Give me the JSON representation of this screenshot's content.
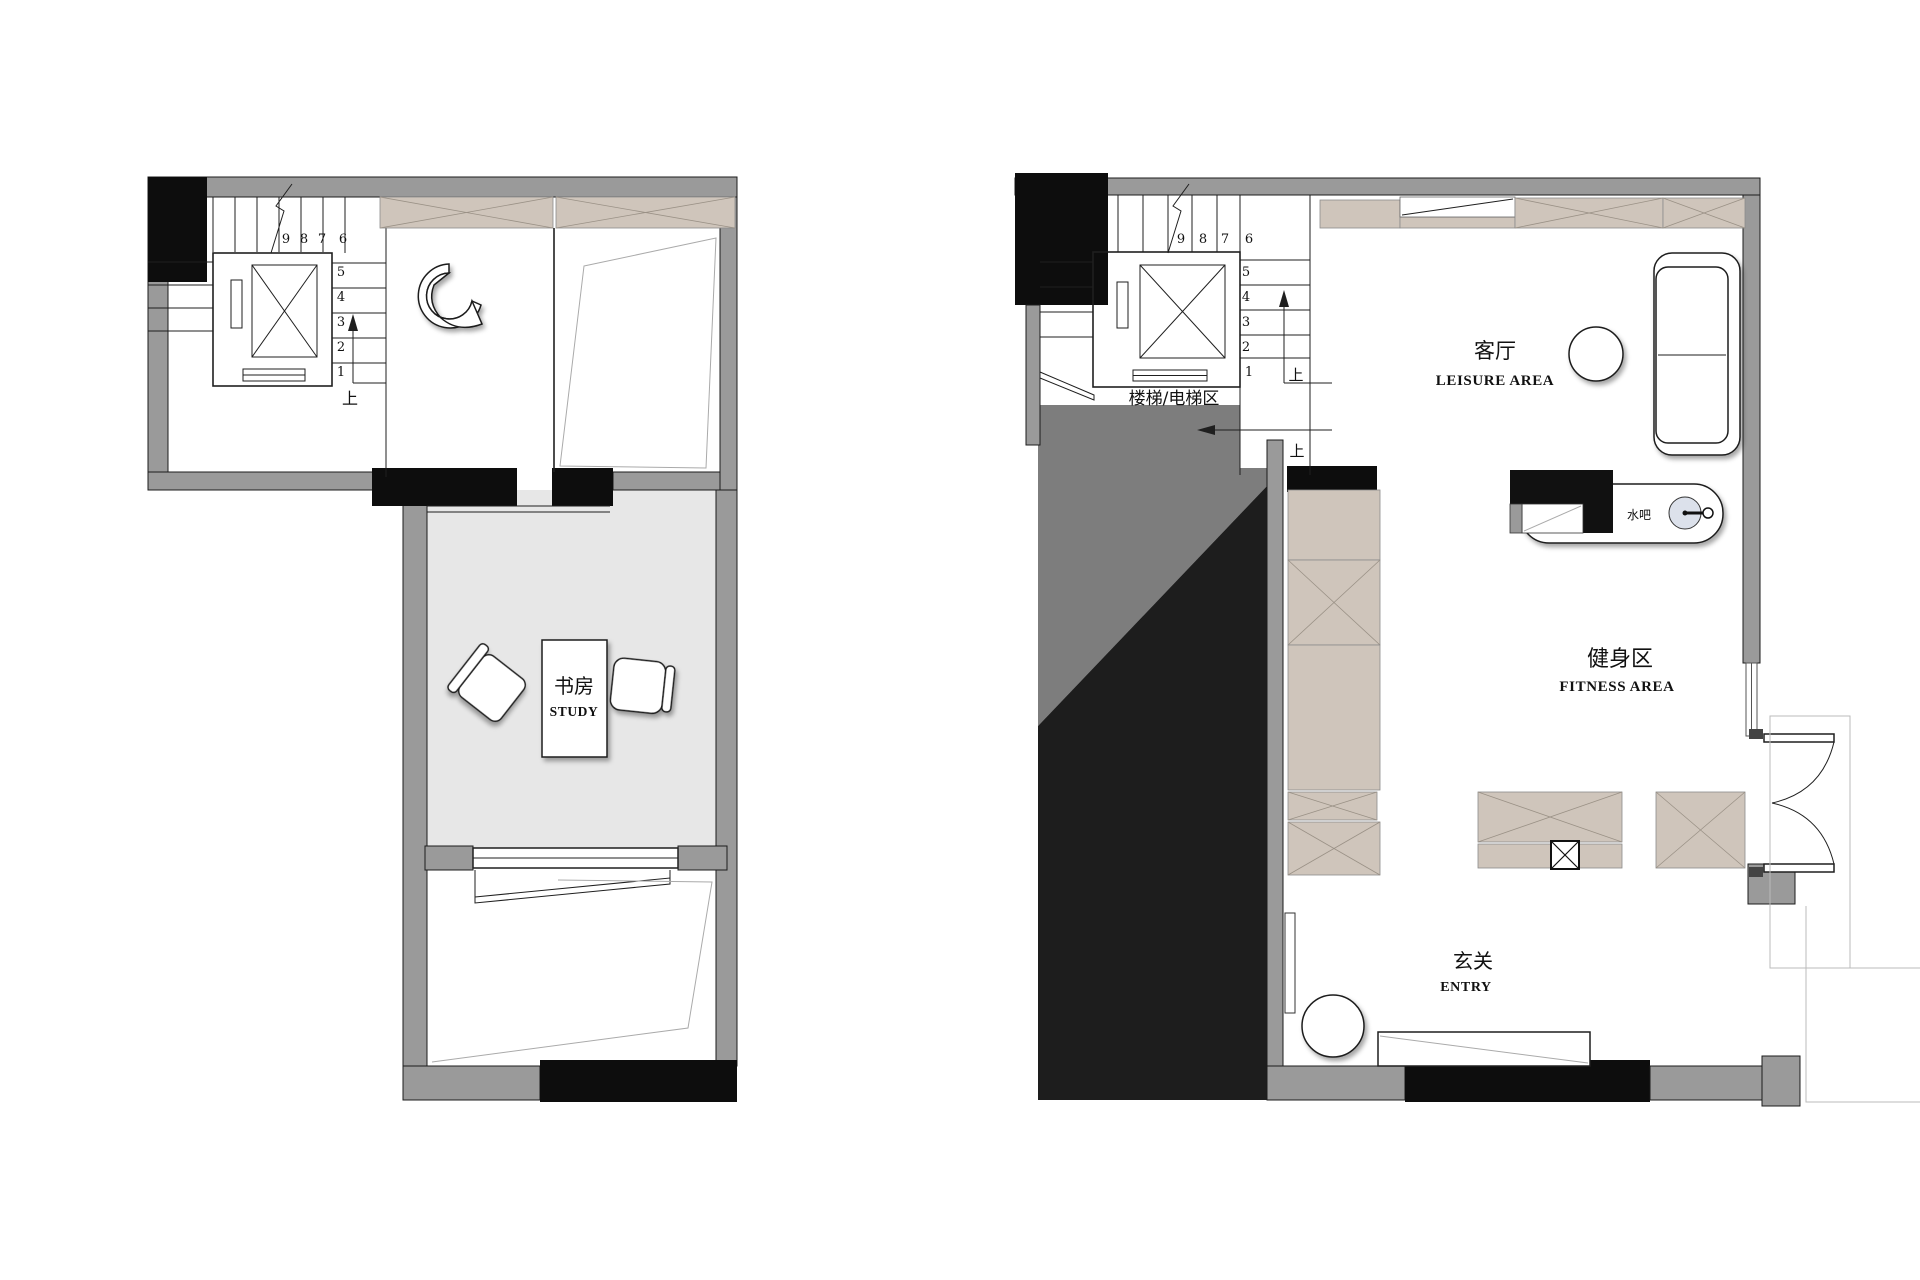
{
  "title_hidden": "",
  "colors": {
    "wall_gray": "#9A9A9A",
    "wall_black": "#0D0D0D",
    "void_black": "#1D1D1D",
    "void_gray": "#7D7D7D",
    "cabinet_tan": "#CFC5BB",
    "study_floor": "#E7E7E7",
    "sink_fill": "#DCE1EB",
    "line_dark": "#1F1F1F",
    "line_faint": "#BBBBBB"
  },
  "left_plan": {
    "study": {
      "zh": "书房",
      "en": "STUDY"
    },
    "stairs": {
      "top_numbers": [
        "9",
        "8",
        "7",
        "6"
      ],
      "side_numbers": [
        "5",
        "4",
        "3",
        "2",
        "1"
      ],
      "up_label": "上"
    }
  },
  "right_plan": {
    "stair_area_label": "楼梯/电梯区",
    "stairs": {
      "top_numbers": [
        "9",
        "8",
        "7",
        "6"
      ],
      "side_numbers": [
        "5",
        "4",
        "3",
        "2",
        "1"
      ],
      "up_label_1": "上",
      "up_label_2": "上"
    },
    "leisure": {
      "zh": "客厅",
      "en": "LEISURE AREA"
    },
    "fitness": {
      "zh": "健身区",
      "en": "FITNESS AREA"
    },
    "entry": {
      "zh": "玄关",
      "en": "ENTRY"
    },
    "water_bar": "水吧"
  }
}
